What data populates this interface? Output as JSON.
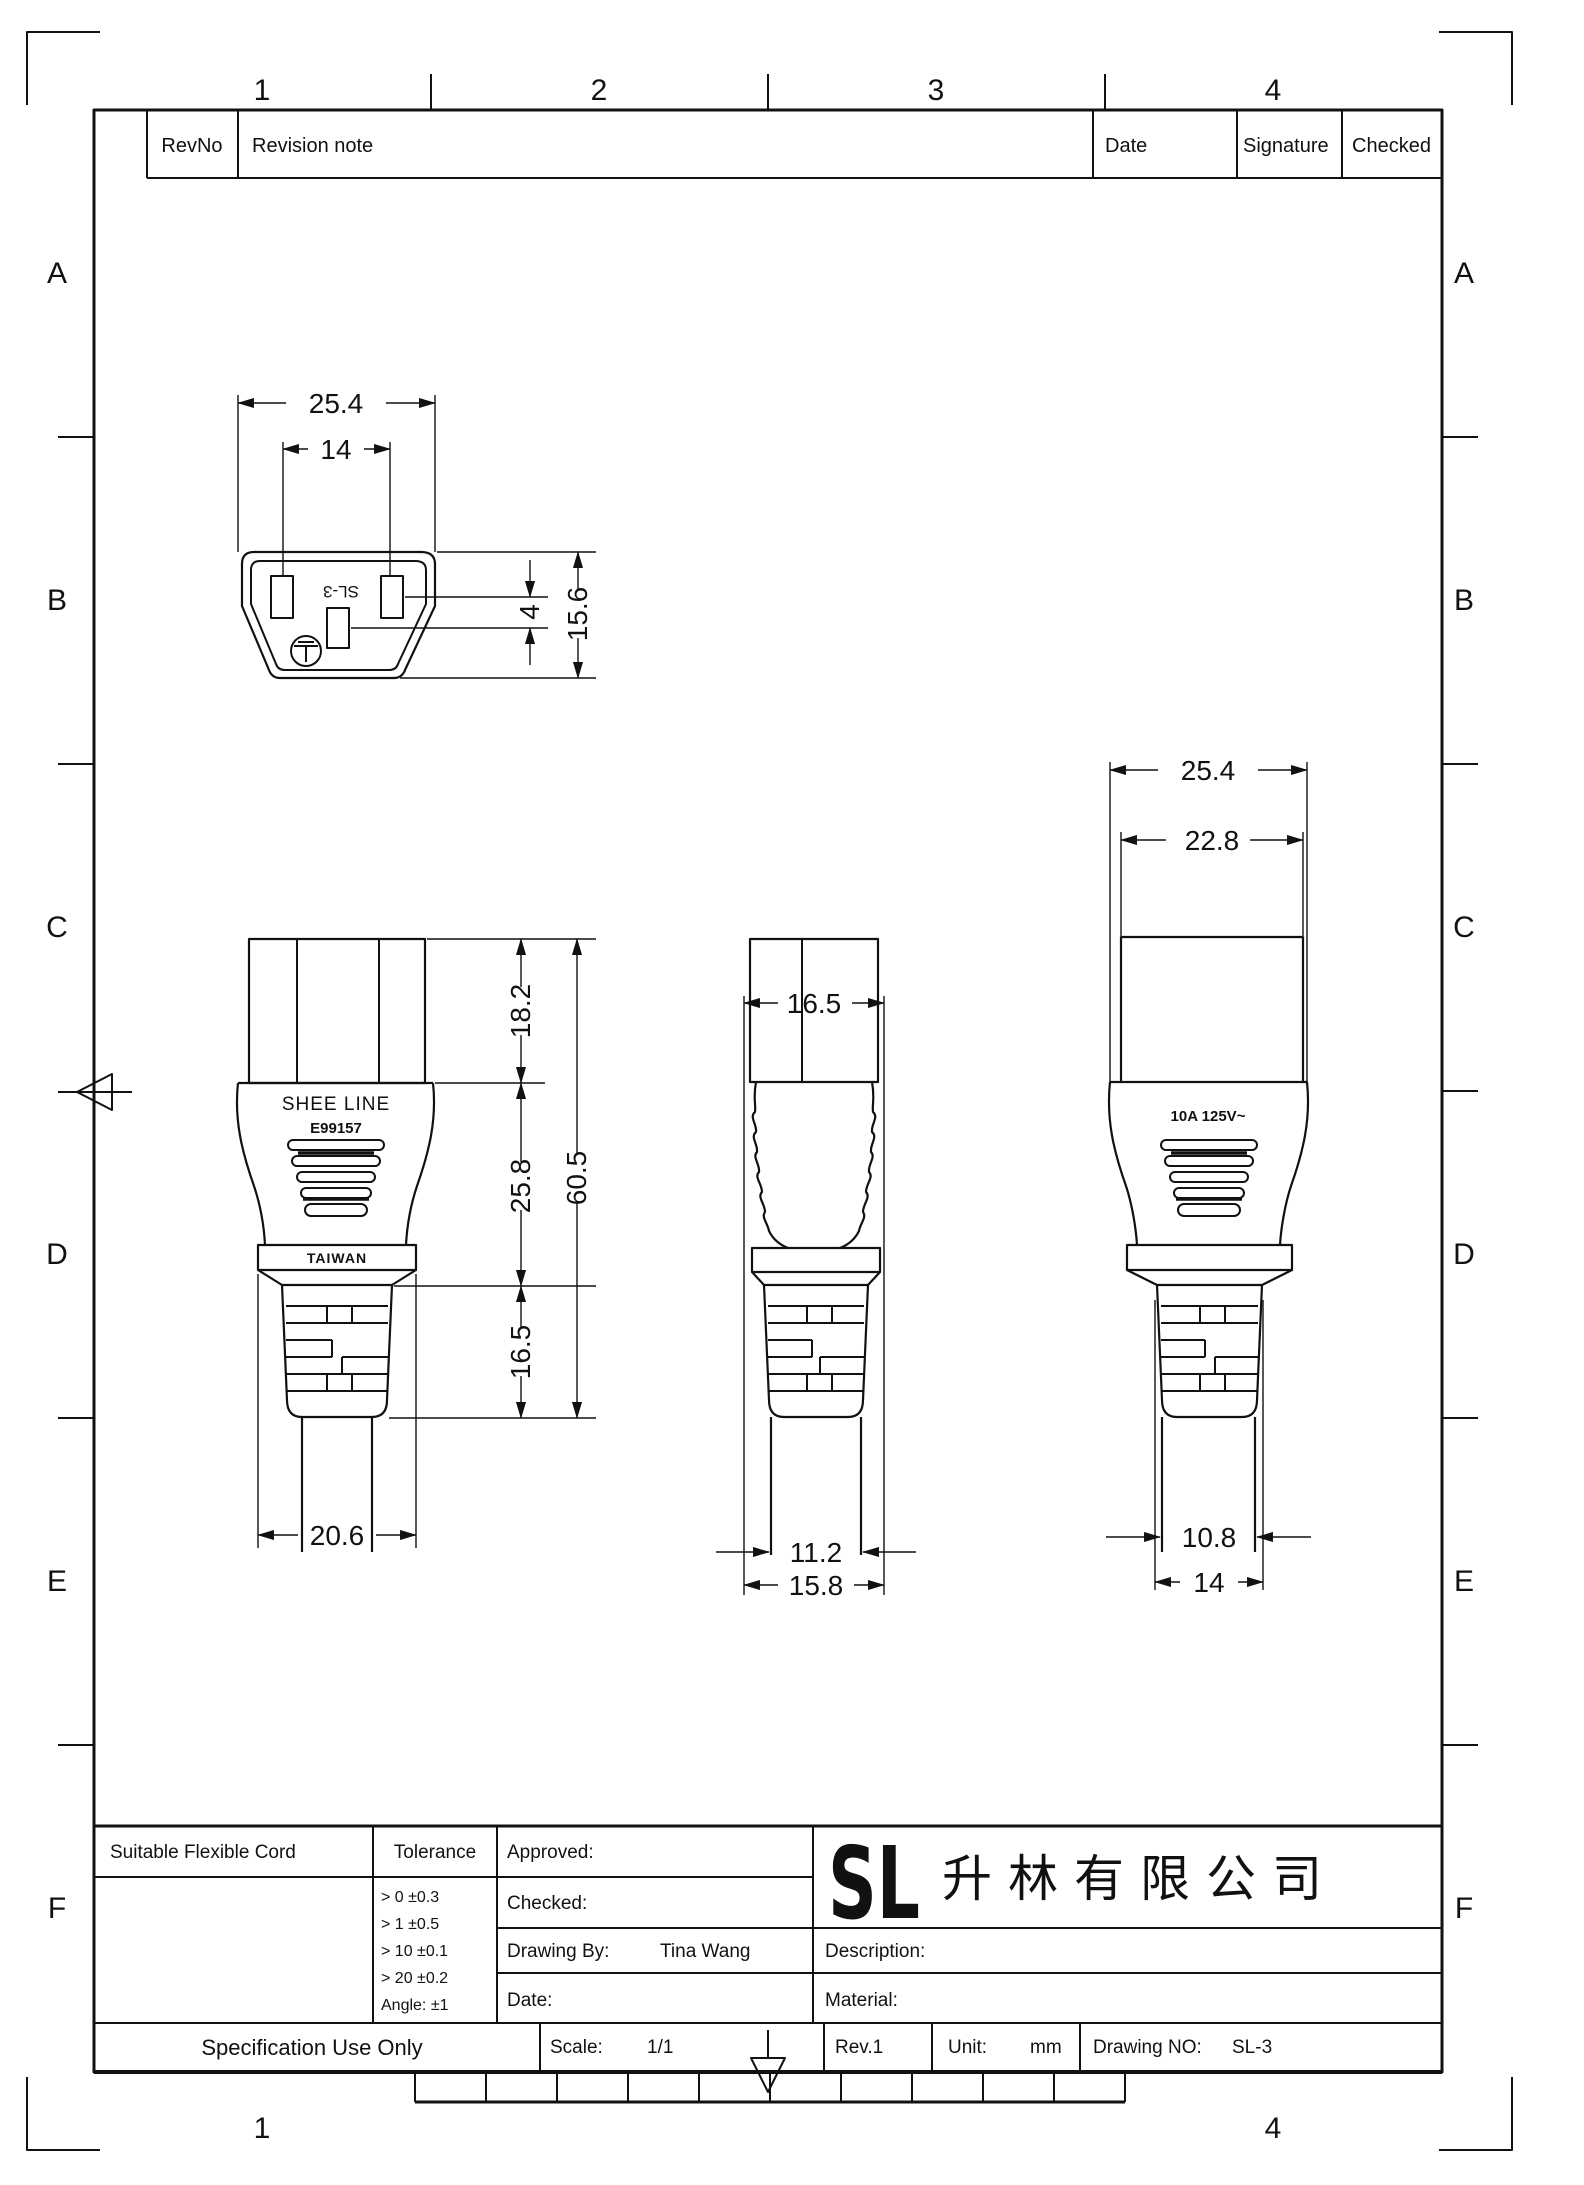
{
  "sheet": {
    "zones": {
      "columns": [
        "1",
        "2",
        "3",
        "4"
      ],
      "rows": [
        "A",
        "B",
        "C",
        "D",
        "E",
        "F"
      ]
    }
  },
  "revision_table": {
    "rev_no": "RevNo",
    "note": "Revision note",
    "date": "Date",
    "signature": "Signature",
    "checked": "Checked"
  },
  "drawing": {
    "face_view": {
      "marking": "SL-3",
      "dim_width": "25.4",
      "dim_pin_spacing": "14",
      "dim_pin_offset": "4",
      "dim_height": "15.6"
    },
    "front_view": {
      "brand": "SHEE LINE",
      "cert_no": "E99157",
      "origin": "TAIWAN",
      "dim_head": "18.2",
      "dim_body": "25.8",
      "dim_relief": "16.5",
      "dim_total": "60.5",
      "dim_band": "20.6"
    },
    "side_view": {
      "dim_width": "16.5",
      "dim_cable": "11.2",
      "dim_relief": "15.8"
    },
    "rear_view": {
      "rating": "10A 125V~",
      "dim_outer": "25.4",
      "dim_inner": "22.8",
      "dim_cable": "10.8",
      "dim_relief": "14"
    }
  },
  "title_block": {
    "suitable": "Suitable Flexible Cord",
    "tolerance": {
      "label": "Tolerance",
      "rows": [
        "> 0  ±0.3",
        "> 1  ±0.5",
        "> 10  ±0.1",
        "> 20  ±0.2",
        "Angle: ±1"
      ]
    },
    "approved": "Approved:",
    "checked": "Checked:",
    "drawing_by": "Drawing By:",
    "drawing_by_value": "Tina Wang",
    "date": "Date:",
    "description": "Description:",
    "material": "Material:",
    "logo": {
      "text": "SL",
      "company": "升林有限公司",
      "color": "#2ecc2e"
    },
    "footer": {
      "spec": "Specification Use Only",
      "scale_label": "Scale:",
      "scale_value": "1/1",
      "rev": "Rev.1",
      "unit_label": "Unit:",
      "unit_value": "mm",
      "drawing_no_label": "Drawing NO:",
      "drawing_no_value": "SL-3"
    }
  }
}
